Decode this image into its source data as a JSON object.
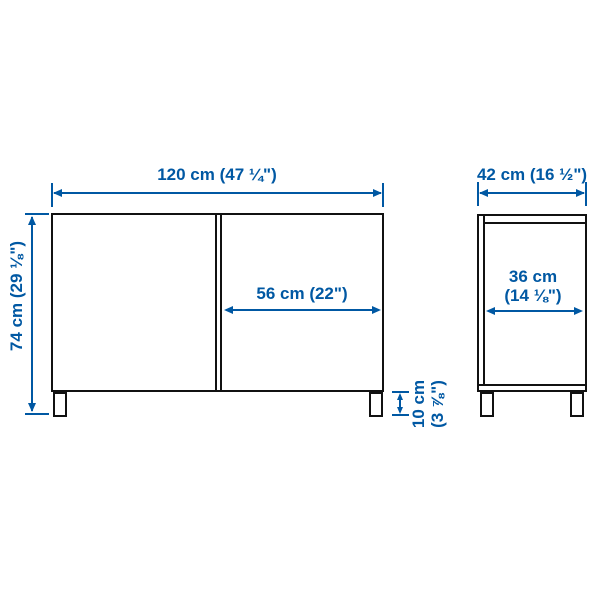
{
  "colors": {
    "dimension_blue": "#0058A3",
    "outline_black": "#111111",
    "background": "#FFFFFF"
  },
  "front_view": {
    "width_label": "120 cm (47 ¼\")",
    "height_label": "74 cm (29 ⅛\")",
    "door_width_label": "56 cm (22\")",
    "leg_height_label": {
      "line1": "10 cm",
      "line2": "(3 ⅞\")"
    }
  },
  "side_view": {
    "depth_label": "42 cm (16 ½\")",
    "inner_depth_label": {
      "line1": "36 cm",
      "line2": "(14 ⅛\")"
    }
  }
}
